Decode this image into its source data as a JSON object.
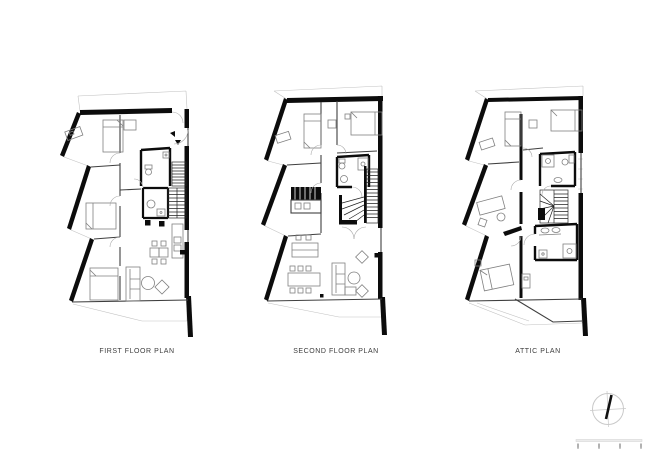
{
  "sheet": {
    "background": "#ffffff"
  },
  "plans": [
    {
      "id": "first-floor",
      "label": "FIRST FLOOR PLAN"
    },
    {
      "id": "second-floor",
      "label": "SECOND FLOOR PLAN"
    },
    {
      "id": "attic",
      "label": "ATTIC PLAN"
    }
  ],
  "compass": {
    "icon": "north-arrow-icon"
  },
  "scale_bar": {
    "icon": "scale-bar",
    "tick_count": 4
  },
  "colors": {
    "wall": "#0c0c0c",
    "partition": "#3f3f3f",
    "furniture": "#808080",
    "light_line": "#c2c2c2",
    "label_text": "#3c3c3c"
  }
}
